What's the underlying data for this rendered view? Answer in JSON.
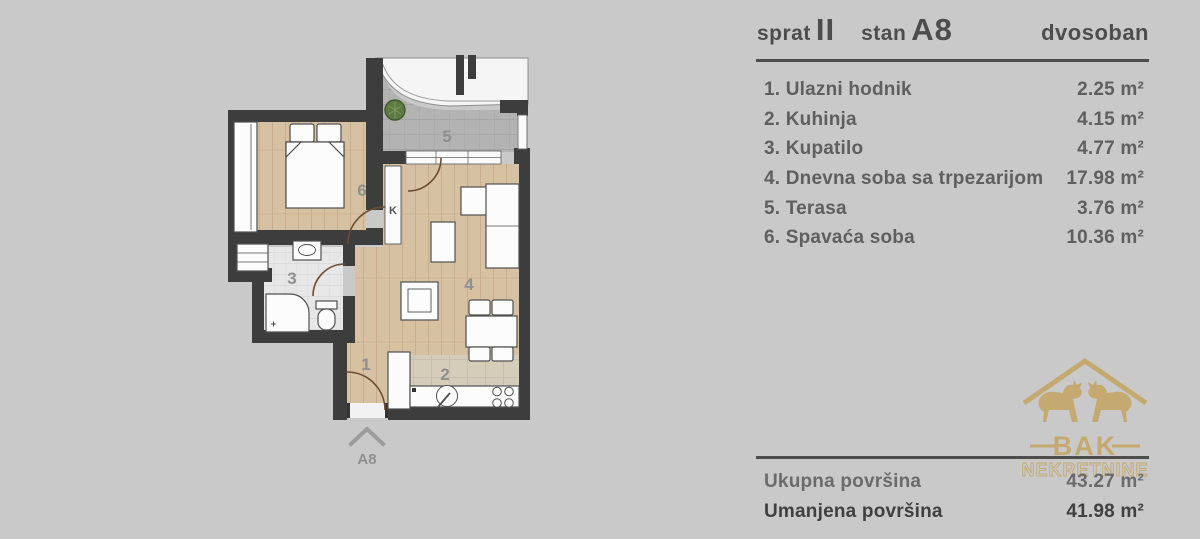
{
  "header": {
    "floor_label": "sprat",
    "floor_value": "II",
    "unit_label": "stan",
    "unit_value": "A8",
    "type_value": "dvosoban"
  },
  "rooms": [
    {
      "name": "1. Ulazni hodnik",
      "area": "2.25 m²"
    },
    {
      "name": "2. Kuhinja",
      "area": "4.15 m²"
    },
    {
      "name": "3. Kupatilo",
      "area": "4.77 m²"
    },
    {
      "name": "4. Dnevna soba sa trpezarijom",
      "area": "17.98 m²"
    },
    {
      "name": "5. Terasa",
      "area": "3.76 m²"
    },
    {
      "name": "6. Spavaća soba",
      "area": "10.36 m²"
    }
  ],
  "totals": {
    "gross_label": "Ukupna površina",
    "gross_value": "43.27 m²",
    "net_label": "Umanjena površina",
    "net_value": "41.98 m²"
  },
  "plan": {
    "room_labels": {
      "hall": "1",
      "kitchen": "2",
      "bathroom": "3",
      "living": "4",
      "terrace": "5",
      "bedroom": "6"
    },
    "entrance_label": "A8",
    "shaft_label": "K"
  },
  "logo": {
    "title": "BAK",
    "subtitle": "NEKRETNINE"
  },
  "colors": {
    "bg": "#c9c9c9",
    "wall": "#3d3d3d",
    "wood": "#d7c1a3",
    "wood_line": "#c8ae8d",
    "terrace": "#b3b3b3",
    "terrace_line": "#a5a5a5",
    "bath": "#e7e7e7",
    "bath_line": "#dadada",
    "kitchen": "#d6ccba",
    "kitchen_line": "#c9bfae",
    "text_dark": "#4d4d4d",
    "text_mid": "#5f5f5f",
    "label": "#8f8f8f",
    "gold": "#c4a35c",
    "arc": "#6b4c35"
  }
}
